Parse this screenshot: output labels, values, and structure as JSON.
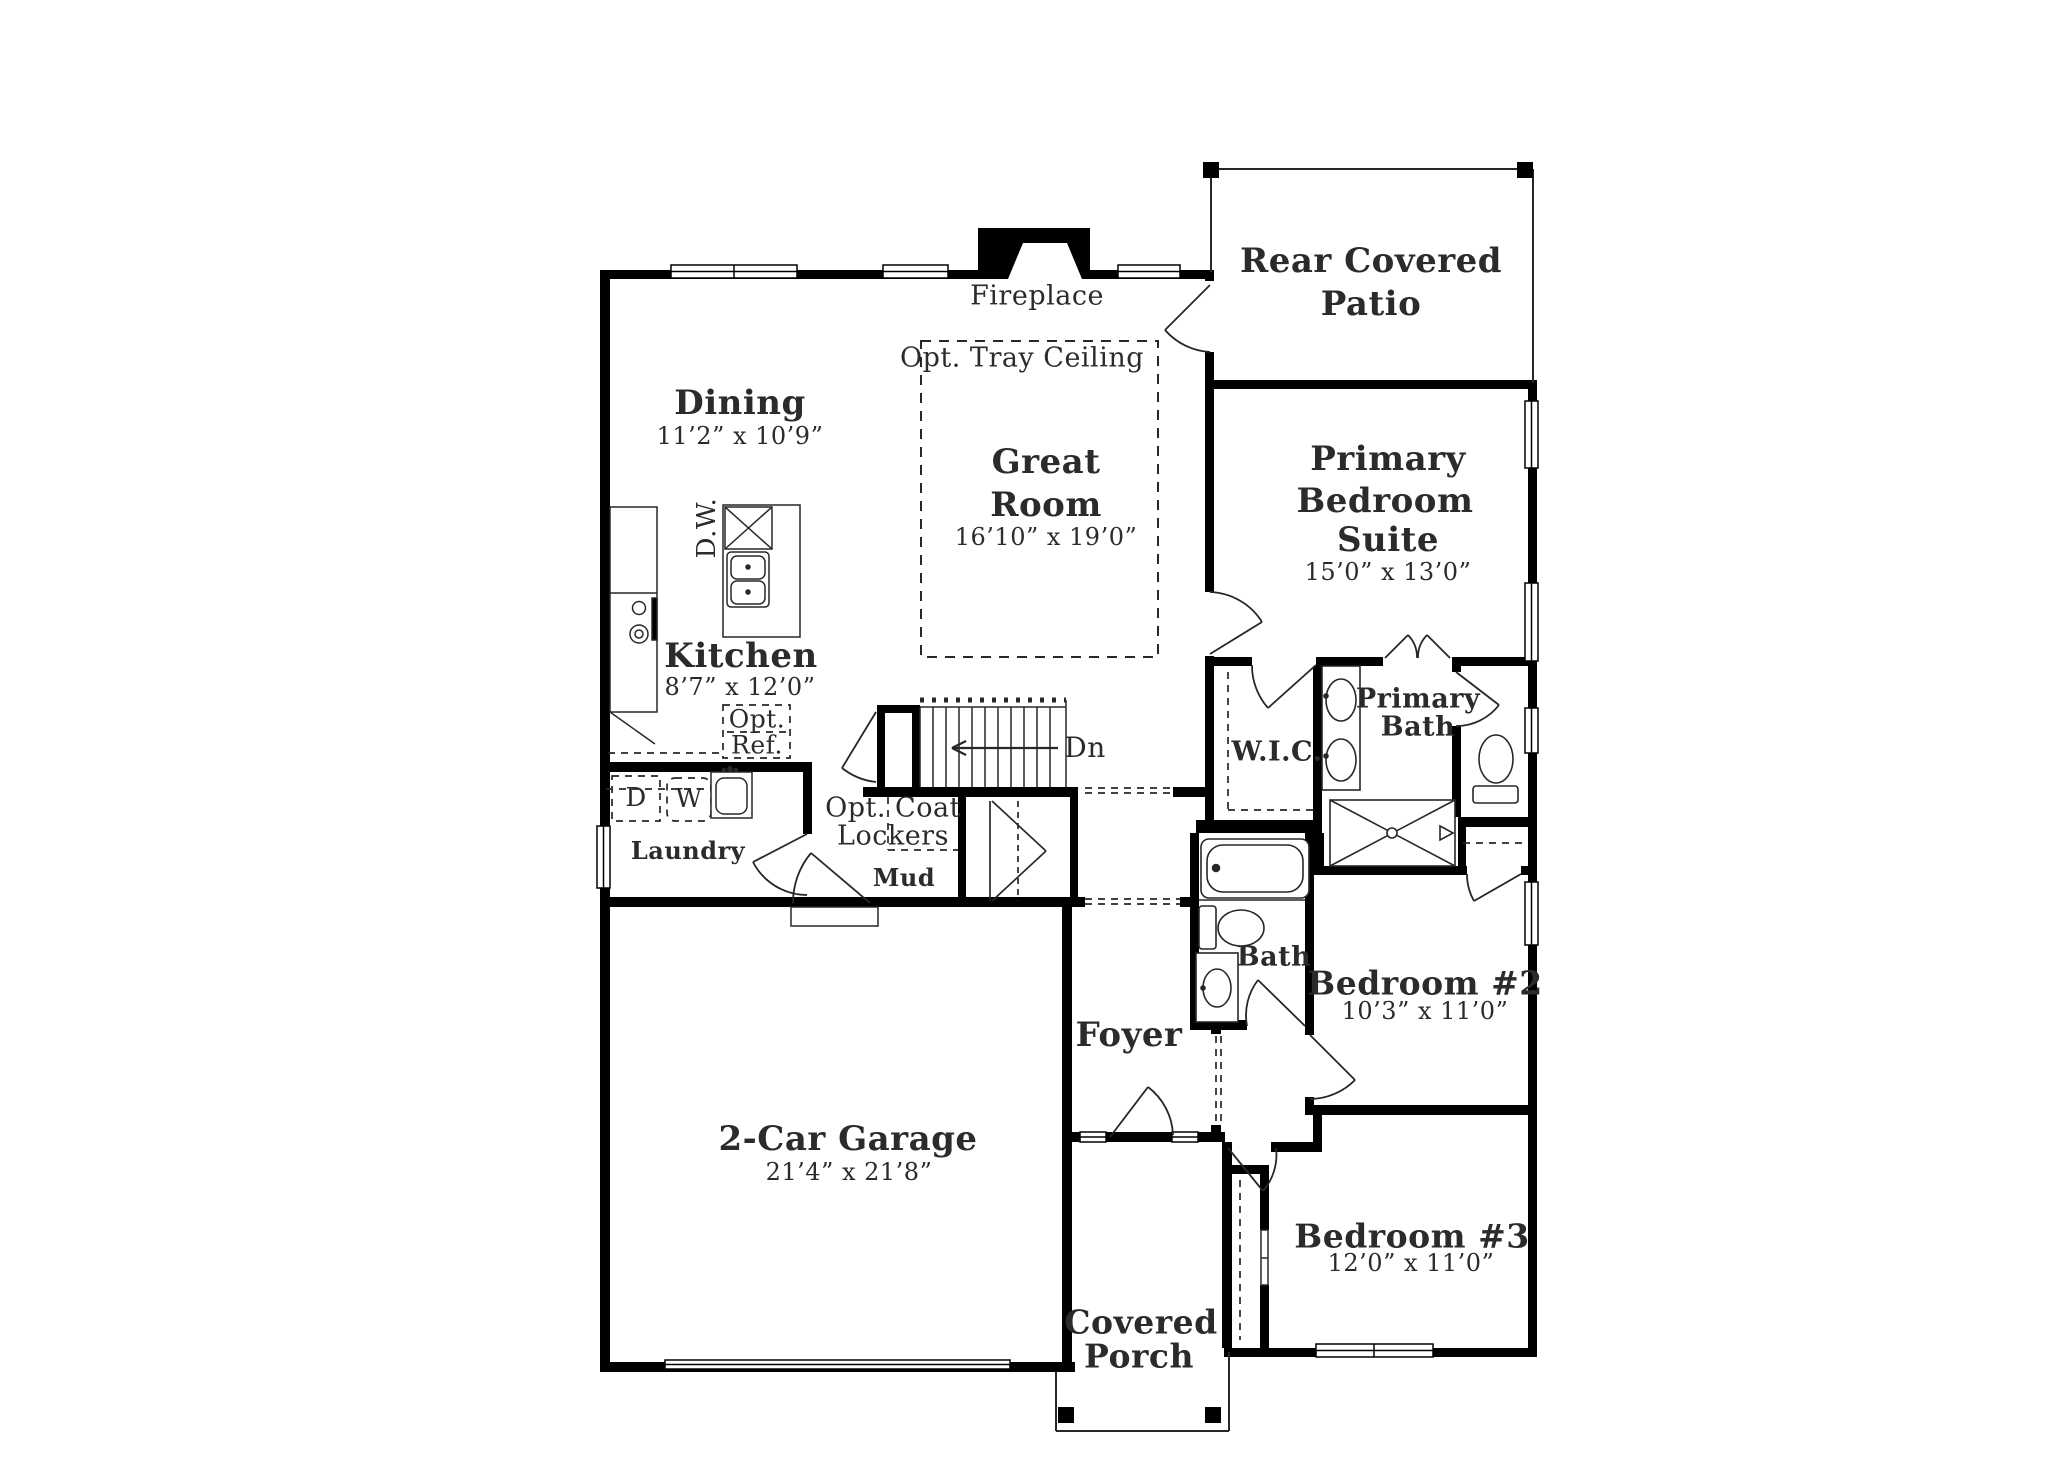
{
  "colors": {
    "wall": "#000000",
    "line": "#2a2627",
    "text": "#2d2a2b",
    "background": "#ffffff"
  },
  "rooms": {
    "patio": {
      "line1": "Rear Covered",
      "line2": "Patio"
    },
    "dining": {
      "name": "Dining",
      "dims": "11’2” x 10’9”"
    },
    "great": {
      "line1": "Great",
      "line2": "Room",
      "dims": "16’10” x 19’0”"
    },
    "kitchen": {
      "name": "Kitchen",
      "dims": "8’7” x 12’0”"
    },
    "primary": {
      "line1": "Primary",
      "line2": "Bedroom",
      "line3": "Suite",
      "dims": "15’0” x 13’0”"
    },
    "wic": {
      "name": "W.I.C."
    },
    "primary_bath": {
      "line1": "Primary",
      "line2": "Bath"
    },
    "laundry": {
      "name": "Laundry"
    },
    "mud": {
      "name": "Mud"
    },
    "bath": {
      "name": "Bath"
    },
    "foyer": {
      "name": "Foyer"
    },
    "bedroom2": {
      "name": "Bedroom #2",
      "dims": "10’3” x 11’0”"
    },
    "bedroom3": {
      "name": "Bedroom #3",
      "dims": "12’0” x 11’0”"
    },
    "garage": {
      "name": "2-Car Garage",
      "dims": "21’4” x 21’8”"
    },
    "porch": {
      "line1": "Covered",
      "line2": "Porch"
    }
  },
  "annotations": {
    "fireplace": "Fireplace",
    "tray_ceiling": "Opt. Tray Ceiling",
    "dishwasher": "D.W.",
    "opt_ref_line1": "Opt.",
    "opt_ref_line2": "Ref.",
    "dryer": "D",
    "washer": "W",
    "lockers_line1": "Opt. Coat",
    "lockers_line2": "Lockers",
    "stairs_down": "Dn"
  }
}
